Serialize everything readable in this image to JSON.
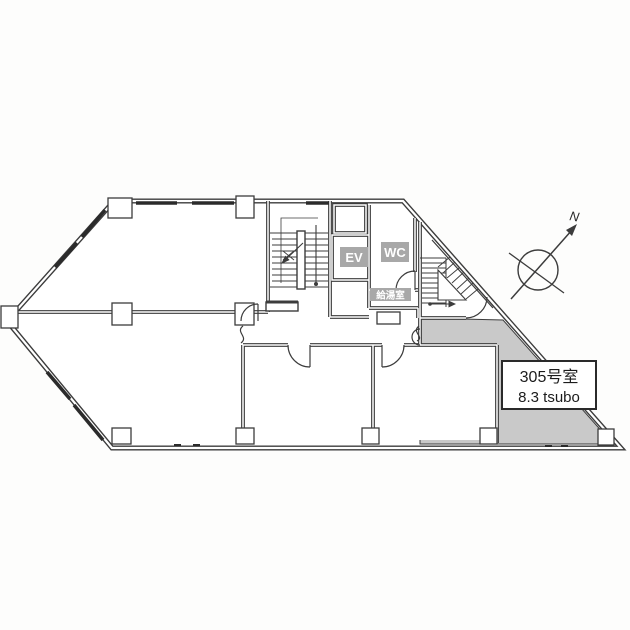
{
  "floor_plan": {
    "labels": {
      "elevator": "EV",
      "toilet": "WC",
      "kitchenette": "給湯室",
      "compass_north": "N"
    },
    "unit": {
      "room_number": "305号室",
      "area": "8.3 tsubo"
    },
    "colors": {
      "wall_line": "#3c3c3c",
      "highlight_room_fill": "#c9c9c9",
      "label_box_fill": "#a8a8a8",
      "unit_box_border": "#2a2a2a",
      "background": "#fdfdfc"
    }
  }
}
